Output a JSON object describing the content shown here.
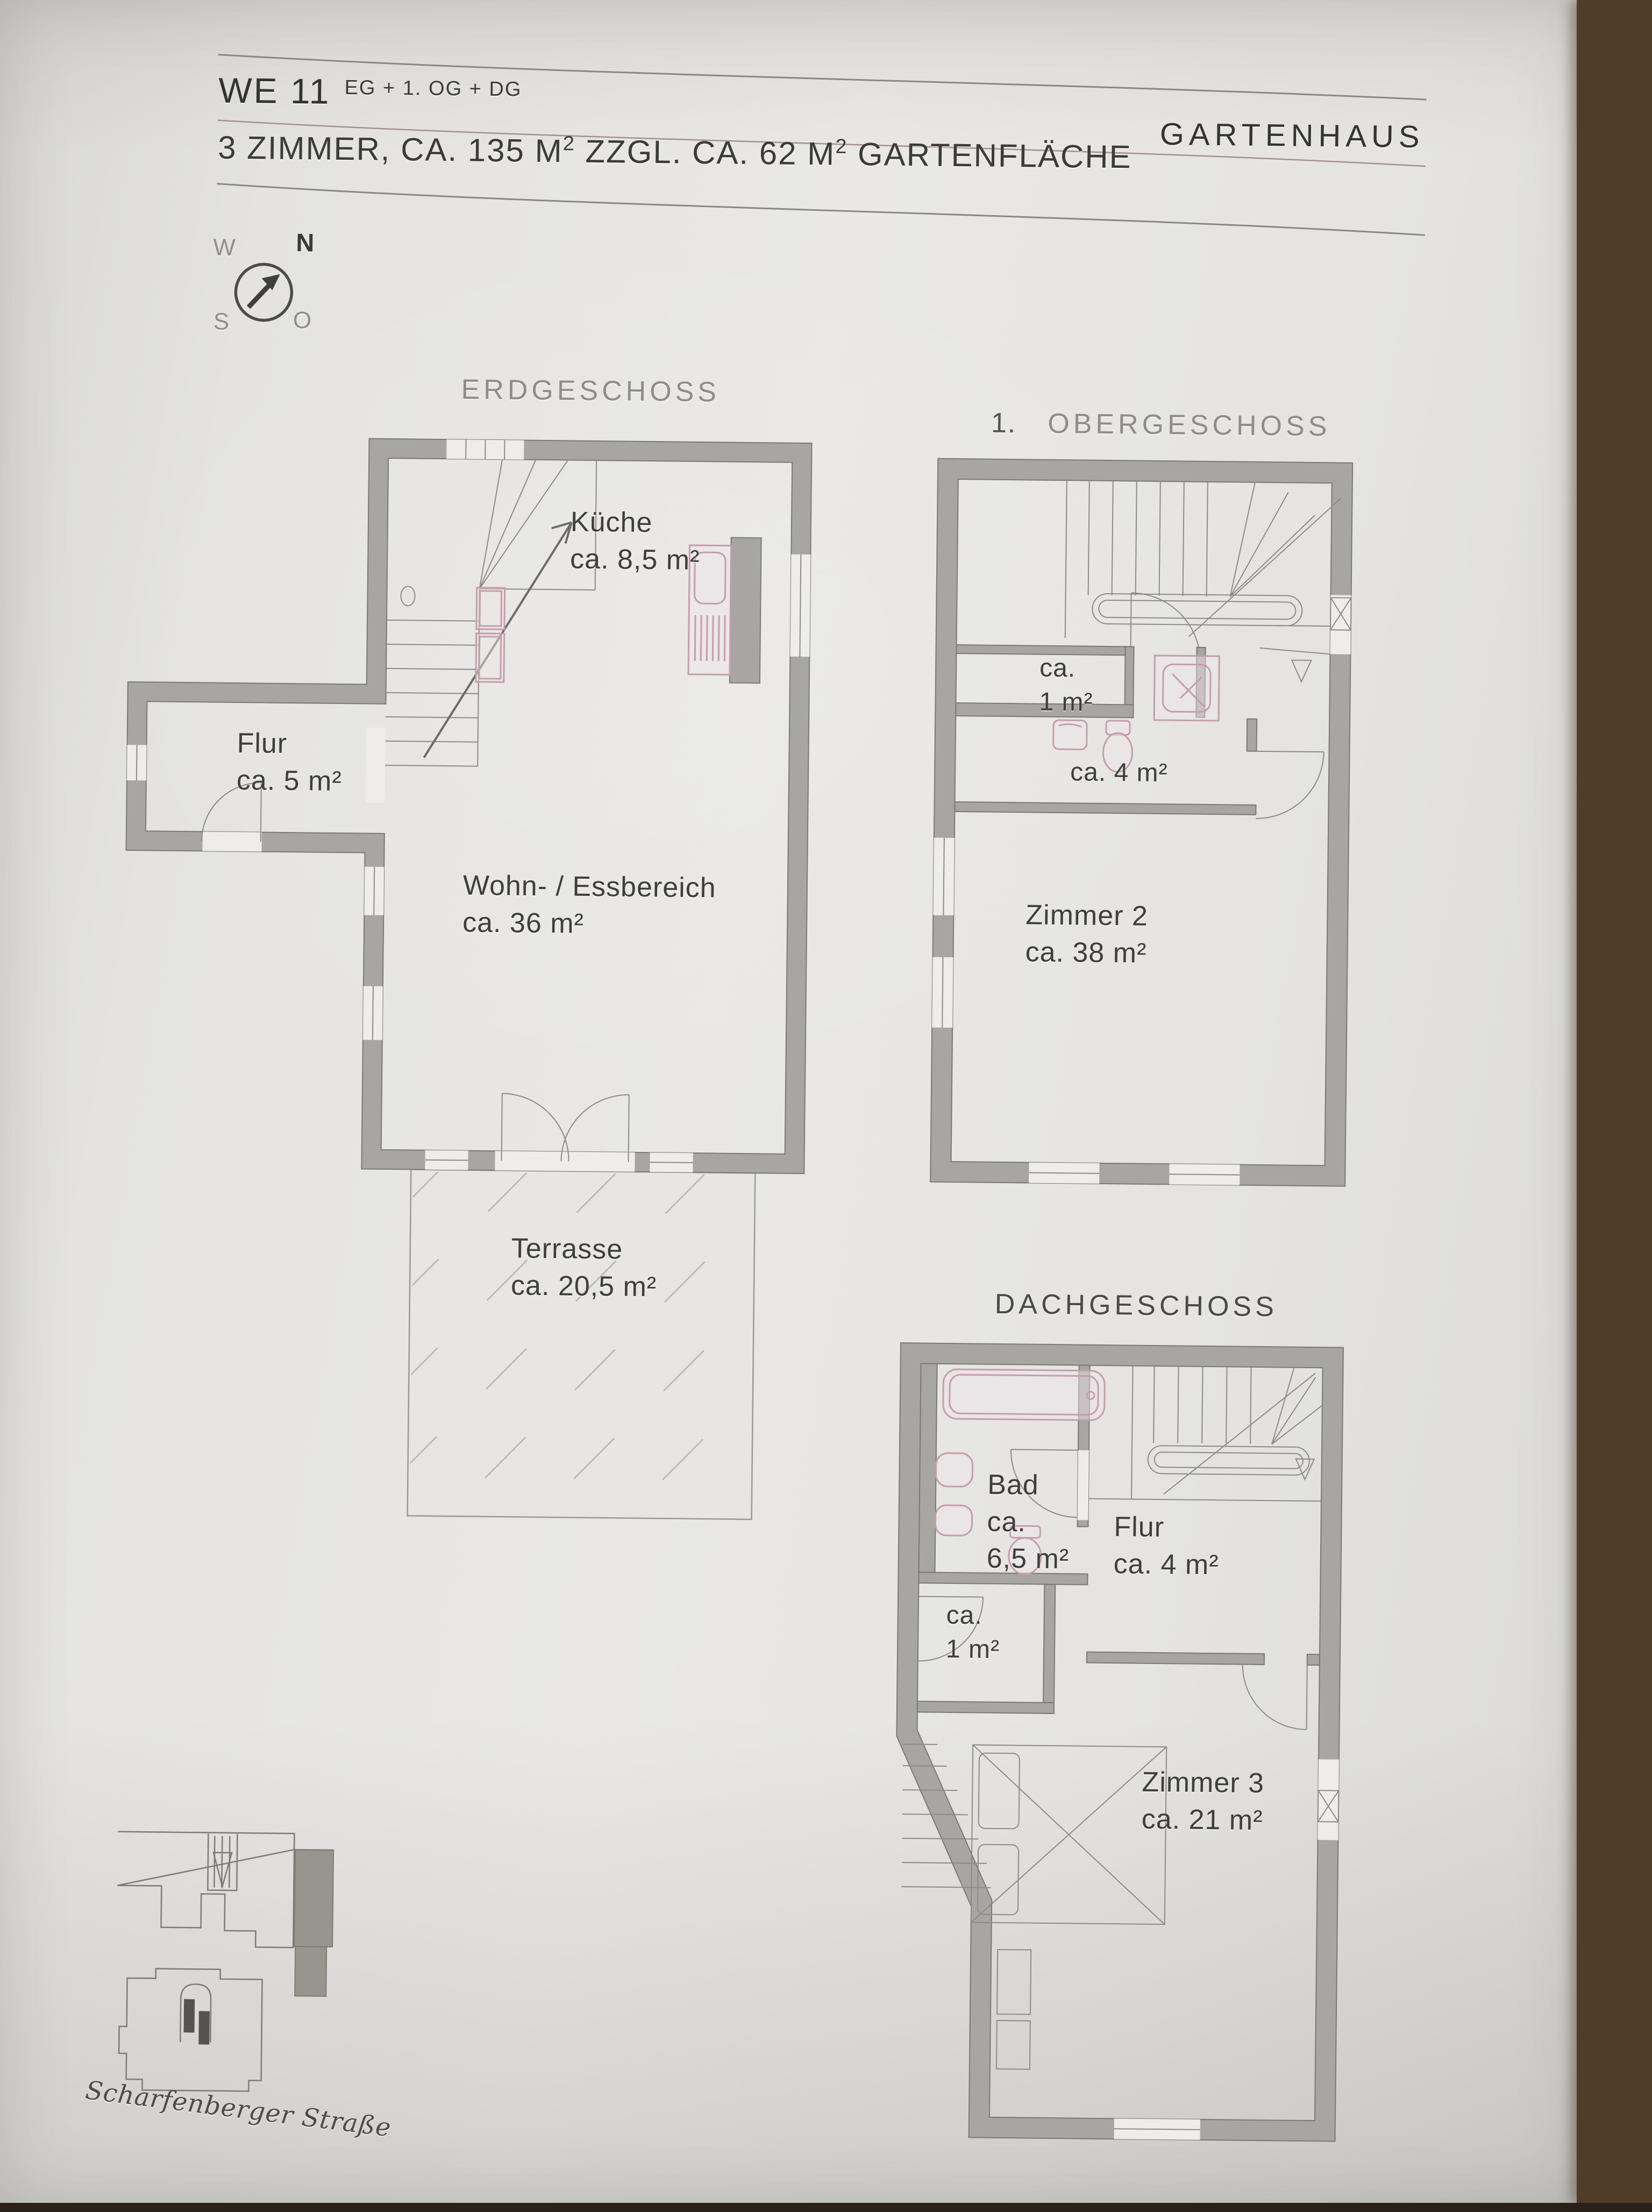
{
  "header": {
    "unit": "WE 11",
    "unit_sup": "EG + 1. OG + DG",
    "building": "GARTENHAUS",
    "subtitle": {
      "part1": "3 ZIMMER, CA. 135 M",
      "sup1": "2",
      "part2": " ZZGL. CA. 62 M",
      "sup2": "2",
      "part3": " GARTENFLÄCHE"
    }
  },
  "compass": {
    "west": "W",
    "north": "N",
    "south": "S",
    "east": "O"
  },
  "floors": {
    "eg": {
      "title": "ERDGESCHOSS",
      "rooms": {
        "kueche": {
          "name": "Küche",
          "area": "ca. 8,5 m²"
        },
        "flur": {
          "name": "Flur",
          "area": "ca. 5 m²"
        },
        "wohn": {
          "name": "Wohn- / Essbereich",
          "area": "ca. 36 m²"
        },
        "terrasse": {
          "name": "Terrasse",
          "area": "ca. 20,5 m²"
        }
      }
    },
    "og": {
      "title_prefix": "1.",
      "title": "OBERGESCHOSS",
      "rooms": {
        "abstell": {
          "line1": "ca.",
          "line2": "1 m²"
        },
        "bad": {
          "area": "ca. 4 m²"
        },
        "zimmer2": {
          "name": "Zimmer 2",
          "area": "ca. 38 m²"
        }
      }
    },
    "dg": {
      "title": "DACHGESCHOSS",
      "rooms": {
        "bad": {
          "name": "Bad",
          "line2": "ca.",
          "line3": "6,5 m²"
        },
        "flur": {
          "name": "Flur",
          "area": "ca. 4 m²"
        },
        "abstell": {
          "line1": "ca.",
          "line2": "1 m²"
        },
        "zimmer3": {
          "name": "Zimmer 3",
          "area": "ca. 21 m²"
        }
      }
    }
  },
  "site": {
    "street": "Scharfenberger Straße"
  },
  "colors": {
    "paper": "#e8e7e5",
    "wall_gray": "#a8a6a2",
    "fixture_pink": "#c59dab",
    "wood_edge": "#5a452f",
    "text": "#3e3e3c"
  }
}
